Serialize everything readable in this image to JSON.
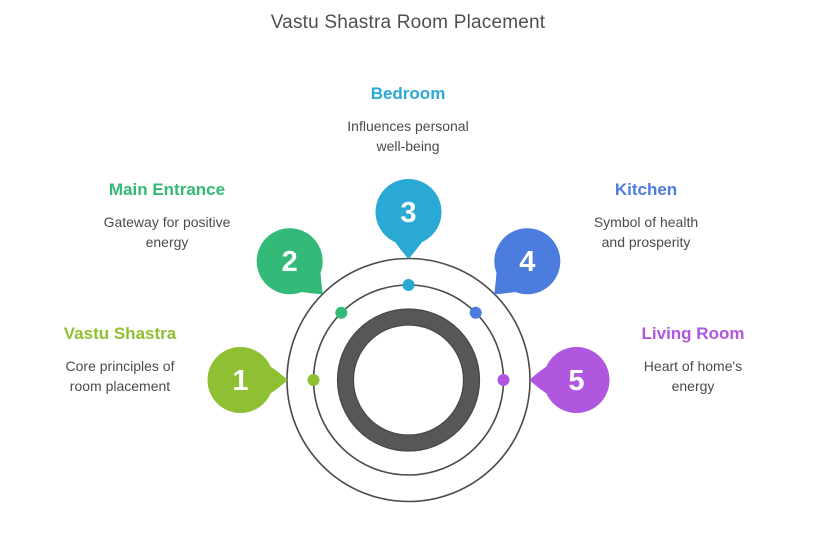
{
  "title": "Vastu Shastra Room Placement",
  "colors": {
    "ring": "#4a4a4a",
    "donut": "#575757",
    "donut_edge": "#464646"
  },
  "items": [
    {
      "number": "1",
      "heading": "Vastu Shastra",
      "color": "#8FBF33",
      "lines": [
        "Core principles of",
        "room placement"
      ]
    },
    {
      "number": "2",
      "heading": "Main Entrance",
      "color": "#33BA78",
      "lines": [
        "Gateway for positive",
        "energy"
      ]
    },
    {
      "number": "3",
      "heading": "Bedroom",
      "color": "#29A9D4",
      "lines": [
        "Influences personal",
        "well-being"
      ]
    },
    {
      "number": "4",
      "heading": "Kitchen",
      "color": "#4C7CDE",
      "lines": [
        "Symbol of health",
        "and prosperity"
      ]
    },
    {
      "number": "5",
      "heading": "Living Room",
      "color": "#B156DE",
      "lines": [
        "Heart of home's",
        "energy"
      ]
    }
  ]
}
